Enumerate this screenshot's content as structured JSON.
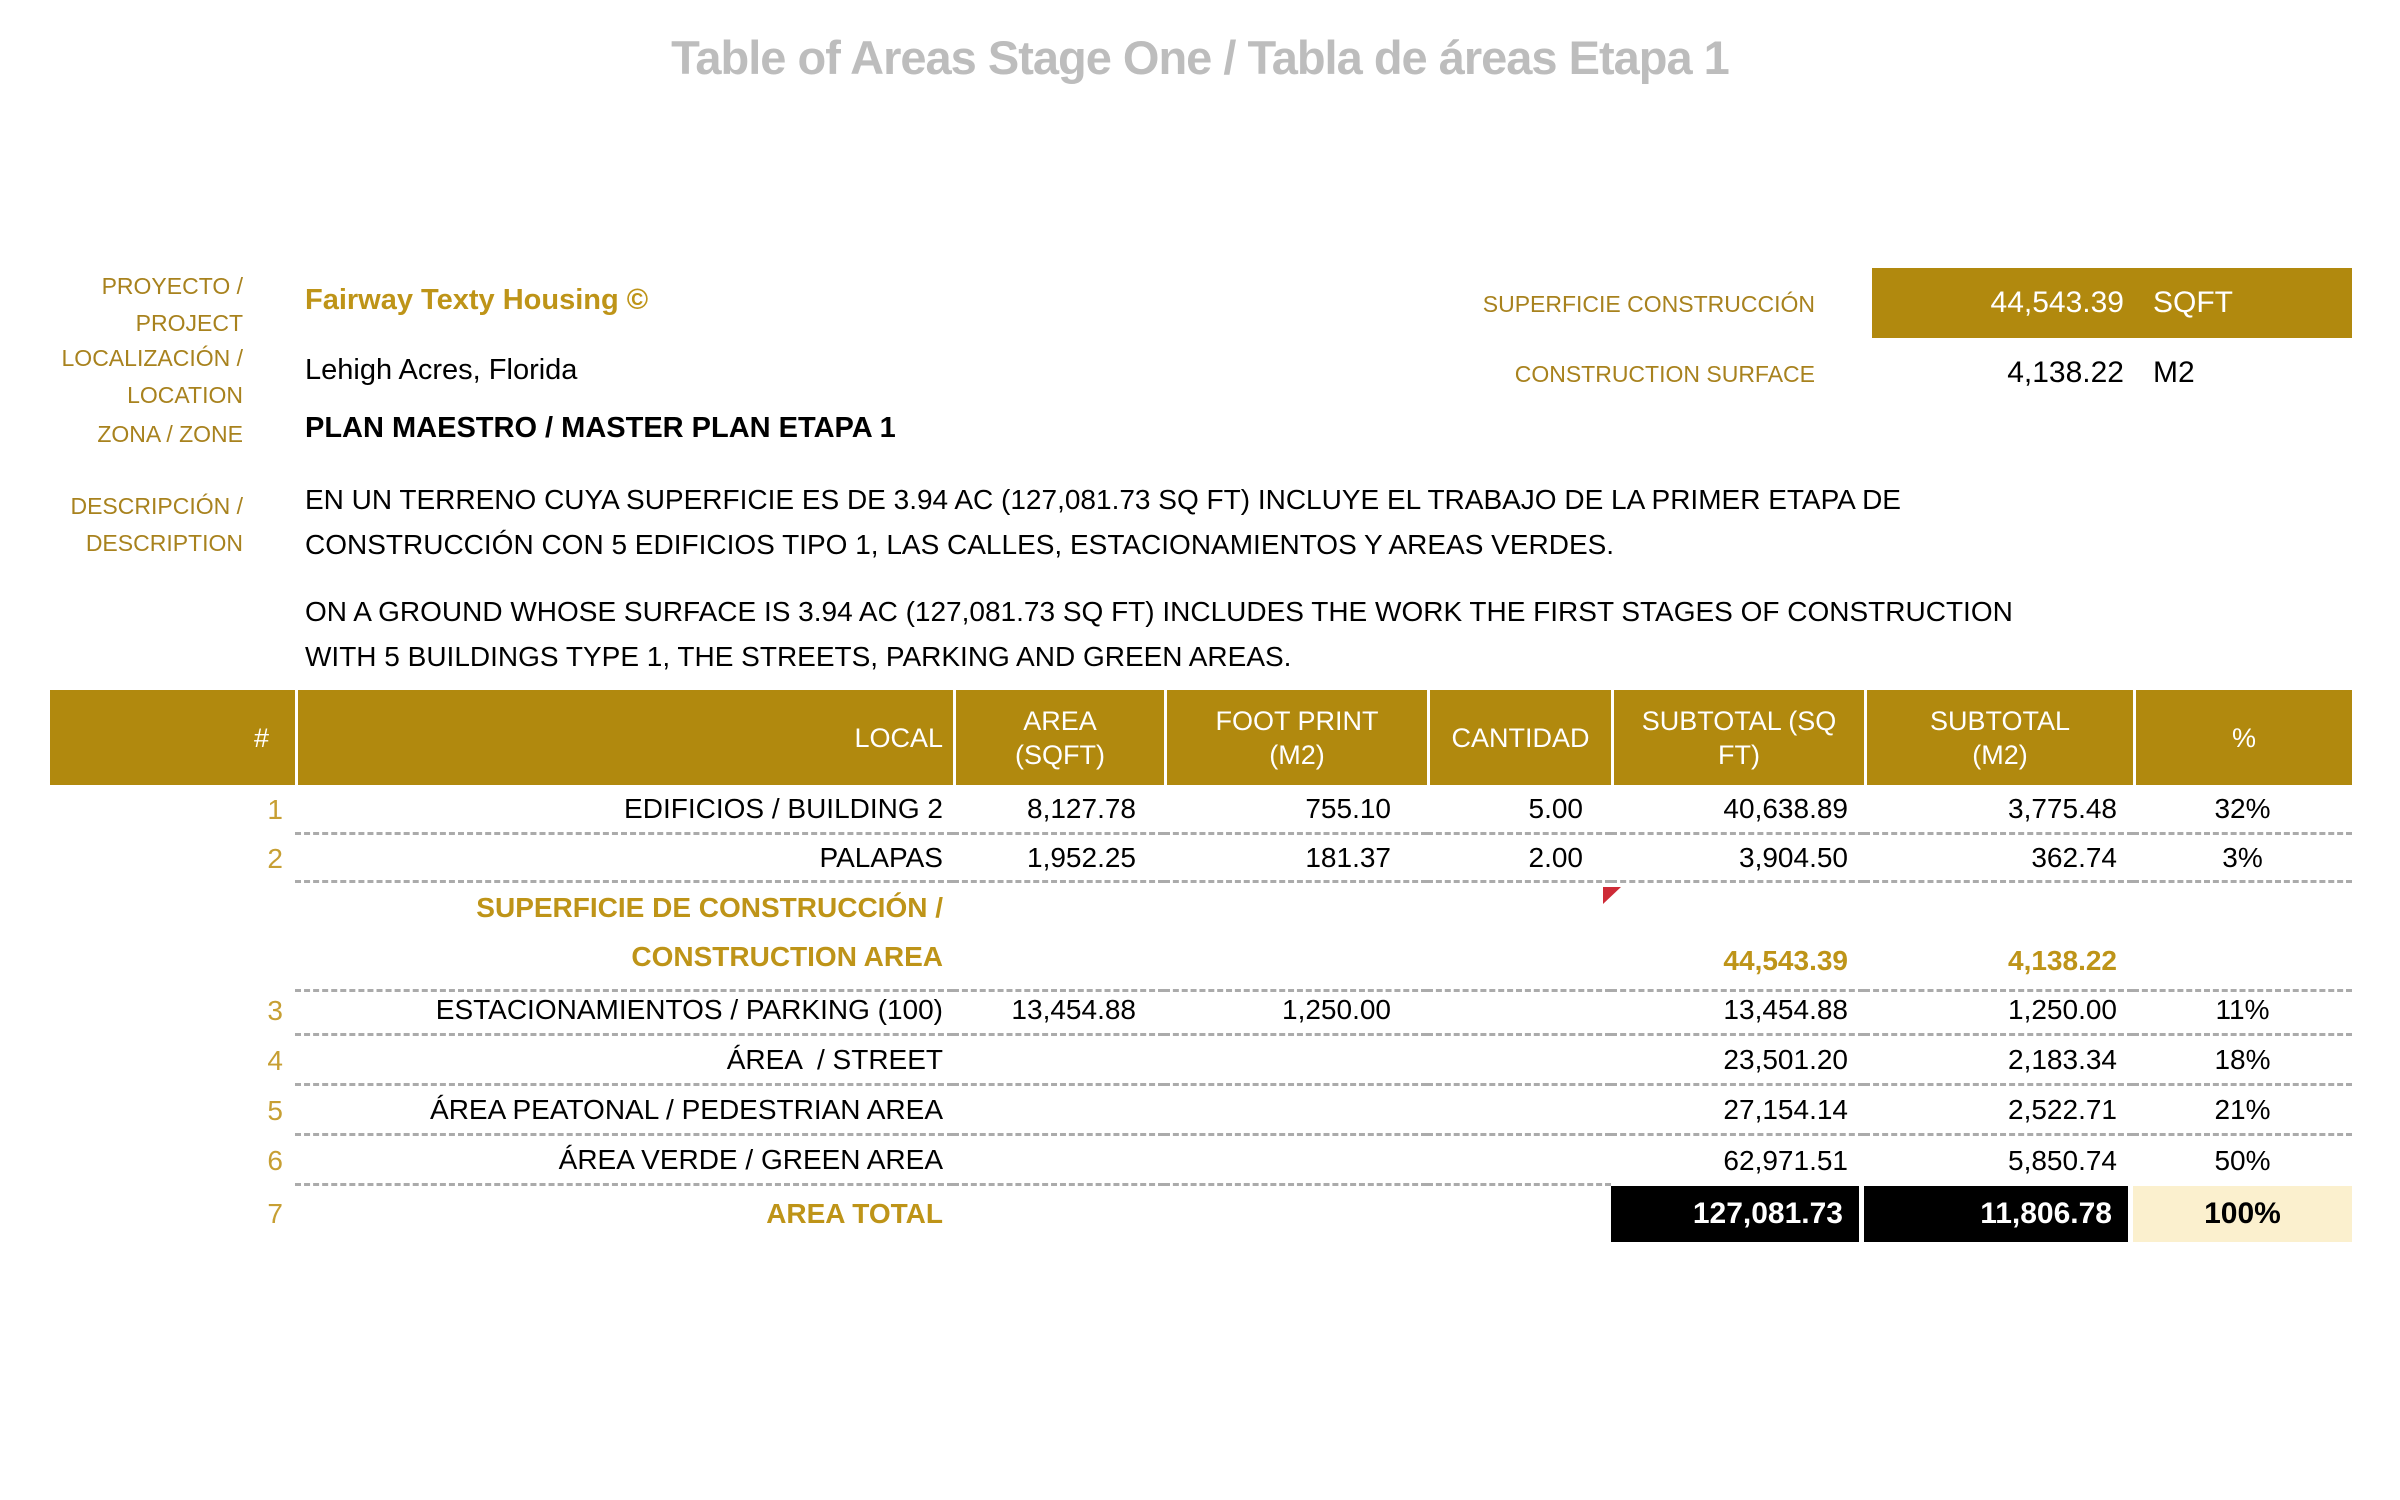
{
  "title": "Table of Areas Stage One / Tabla de áreas Etapa 1",
  "info": {
    "project": {
      "label": "PROYECTO /\nPROJECT",
      "value": "Fairway Texty Housing ©"
    },
    "location": {
      "label": "LOCALIZACIÓN /\nLOCATION",
      "value": "Lehigh Acres, Florida"
    },
    "zone": {
      "label": "ZONA / ZONE",
      "value": "PLAN MAESTRO / MASTER PLAN ETAPA 1"
    },
    "description": {
      "label": "DESCRIPCIÓN /\nDESCRIPTION",
      "paragraph_es": "EN UN TERRENO CUYA SUPERFICIE ES DE 3.94 AC (127,081.73 SQ FT) INCLUYE EL TRABAJO DE LA PRIMER ETAPA DE\nCONSTRUCCIÓN CON 5 EDIFICIOS TIPO 1, LAS CALLES, ESTACIONAMIENTOS Y AREAS VERDES.",
      "paragraph_en": "ON A GROUND WHOSE SURFACE IS 3.94 AC (127,081.73 SQ FT) INCLUDES THE WORK THE FIRST STAGES OF CONSTRUCTION\nWITH 5 BUILDINGS TYPE 1, THE STREETS, PARKING AND GREEN AREAS."
    }
  },
  "construction_summary": {
    "label_es": "SUPERFICIE CONSTRUCCIÓN",
    "label_en": "CONSTRUCTION SURFACE",
    "value_sqft": "44,543.39",
    "unit_sqft": "SQFT",
    "value_m2": "4,138.22",
    "unit_m2": "M2"
  },
  "table": {
    "headers": [
      "#",
      "LOCAL",
      "AREA\n(SQFT)",
      "FOOT PRINT\n(M2)",
      "CANTIDAD",
      "SUBTOTAL (SQ\nFT)",
      "SUBTOTAL\n(M2)",
      "%"
    ],
    "rows": [
      {
        "num": "1",
        "local": "EDIFICIOS / BUILDING 2",
        "area_sqft": "8,127.78",
        "footprint_m2": "755.10",
        "cantidad": "5.00",
        "subtotal_sqft": "40,638.89",
        "subtotal_m2": "3,775.48",
        "pct": "32%",
        "style": "normal"
      },
      {
        "num": "2",
        "local": "PALAPAS",
        "area_sqft": "1,952.25",
        "footprint_m2": "181.37",
        "cantidad": "2.00",
        "subtotal_sqft": "3,904.50",
        "subtotal_m2": "362.74",
        "pct": "3%",
        "style": "normal"
      },
      {
        "num": "",
        "local": "SUPERFICIE DE CONSTRUCCIÓN /\nCONSTRUCTION AREA",
        "area_sqft": "",
        "footprint_m2": "",
        "cantidad": "",
        "subtotal_sqft": "44,543.39",
        "subtotal_m2": "4,138.22",
        "pct": "",
        "style": "construction-subtotal"
      },
      {
        "num": "3",
        "local": "ESTACIONAMIENTOS / PARKING (100)",
        "area_sqft": "13,454.88",
        "footprint_m2": "1,250.00",
        "cantidad": "",
        "subtotal_sqft": "13,454.88",
        "subtotal_m2": "1,250.00",
        "pct": "11%",
        "style": "normal"
      },
      {
        "num": "4",
        "local": "ÁREA  / STREET",
        "area_sqft": "",
        "footprint_m2": "",
        "cantidad": "",
        "subtotal_sqft": "23,501.20",
        "subtotal_m2": "2,183.34",
        "pct": "18%",
        "style": "normal"
      },
      {
        "num": "5",
        "local": "ÁREA PEATONAL / PEDESTRIAN AREA",
        "area_sqft": "",
        "footprint_m2": "",
        "cantidad": "",
        "subtotal_sqft": "27,154.14",
        "subtotal_m2": "2,522.71",
        "pct": "21%",
        "style": "normal"
      },
      {
        "num": "6",
        "local": "ÁREA VERDE / GREEN AREA",
        "area_sqft": "",
        "footprint_m2": "",
        "cantidad": "",
        "subtotal_sqft": "62,971.51",
        "subtotal_m2": "5,850.74",
        "pct": "50%",
        "style": "normal-partial-border"
      },
      {
        "num": "7",
        "local": "AREA TOTAL",
        "area_sqft": "",
        "footprint_m2": "",
        "cantidad": "",
        "subtotal_sqft": "127,081.73",
        "subtotal_m2": "11,806.78",
        "pct": "100%",
        "style": "total"
      }
    ]
  },
  "colors": {
    "gold_fill": "#B1890E",
    "gold_label": "#A8821E",
    "gold_bold_text": "#BE9418",
    "row_number_gold": "#C79F33",
    "title_gray": "#BDBDBD",
    "dash_gray": "#ABABAB",
    "total_cell_black": "#000000",
    "total_pct_bg": "#FBF0CE",
    "flag_red": "#CE2B37"
  }
}
